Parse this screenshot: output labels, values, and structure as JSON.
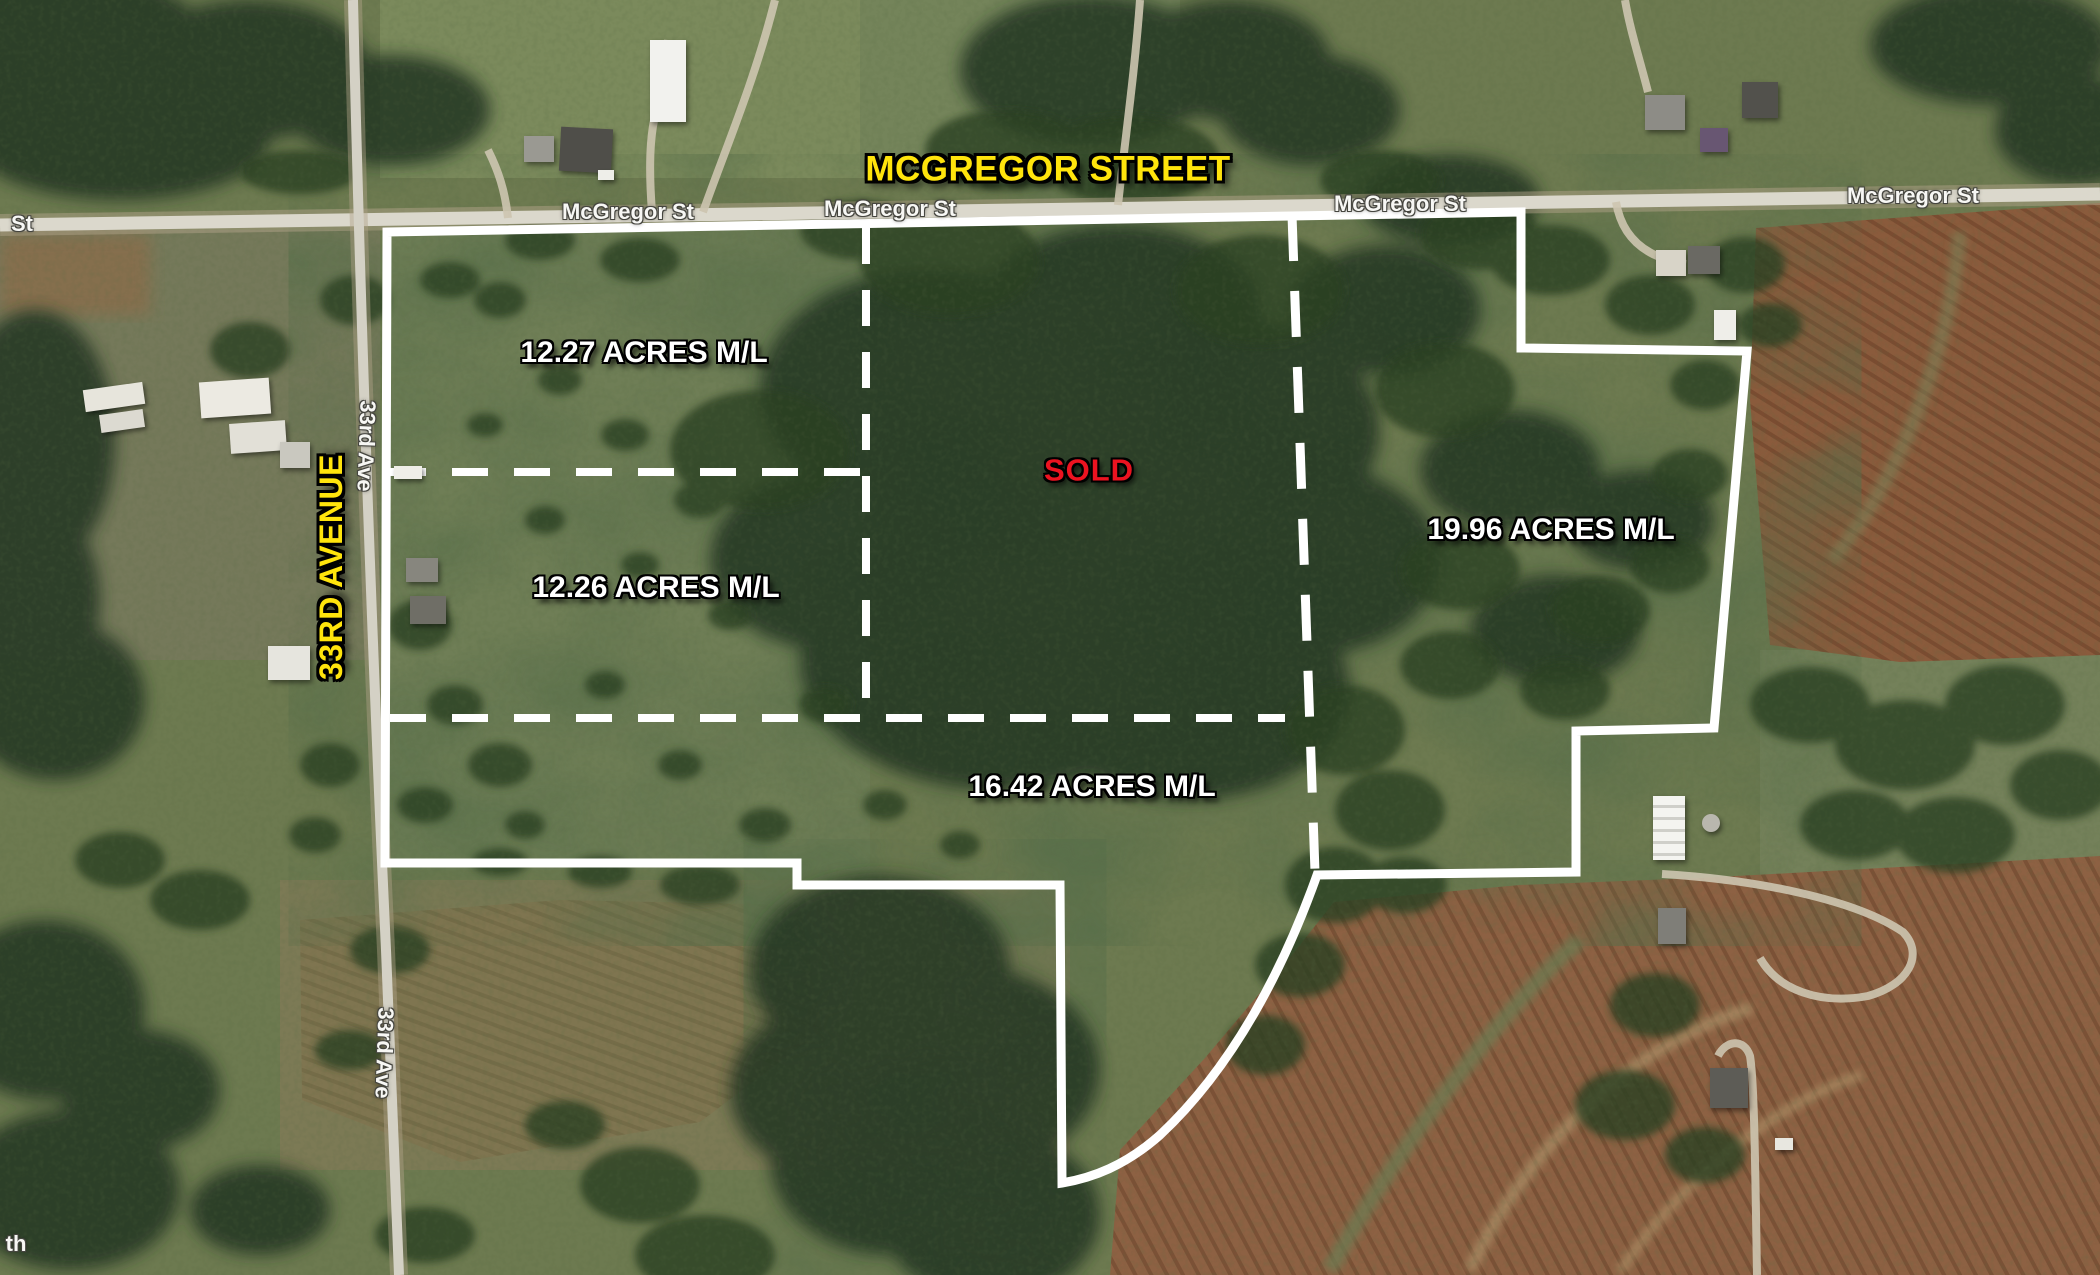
{
  "map": {
    "type": "aerial-parcel-boundary-map",
    "street_labels": {
      "main_street_banner": "MCGREGOR STREET",
      "avenue_banner": "33RD AVENUE",
      "mcgregor_small": "McGregor St",
      "avenue_small": "33rd Ave",
      "left_edge_partial": "St",
      "bottom_edge_partial": "th"
    },
    "parcels": [
      {
        "id": "northwest",
        "label": "12.27 ACRES M/L"
      },
      {
        "id": "west-middle",
        "label": "12.26 ACRES M/L"
      },
      {
        "id": "center",
        "label": "SOLD",
        "status": "sold"
      },
      {
        "id": "south",
        "label": "16.42 ACRES M/L"
      },
      {
        "id": "east",
        "label": "19.96 ACRES M/L"
      }
    ],
    "colors": {
      "street_banner_yellow": "#ffe40c",
      "sold_red": "#ec1320",
      "parcel_text_white": "#ffffff",
      "boundary_white": "#ffffff",
      "road_label_halo": "#45453f"
    }
  }
}
